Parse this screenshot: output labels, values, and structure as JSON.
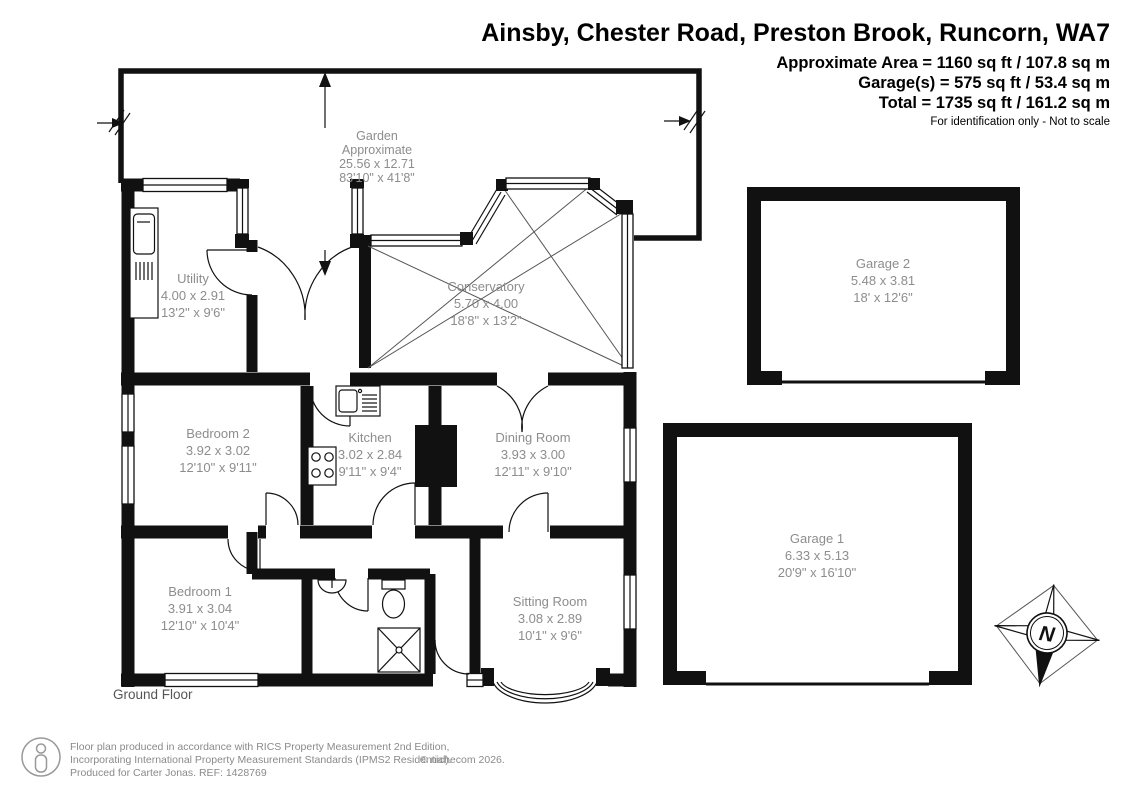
{
  "header": {
    "title": "Ainsby, Chester Road, Preston Brook, Runcorn, WA7",
    "approx_area": "Approximate Area = 1160 sq ft / 107.8 sq m",
    "garages": "Garage(s) = 575 sq ft / 53.4 sq m",
    "total": "Total = 1735 sq ft / 161.2 sq m",
    "disclaimer": "For identification only - Not to scale"
  },
  "floor": {
    "label": "Ground Floor"
  },
  "compass": {
    "north": "N"
  },
  "rooms": {
    "garden": {
      "name": "Garden",
      "sub": "Approximate",
      "metric": "25.56 x 12.71",
      "imperial": "83'10\" x 41'8\""
    },
    "utility": {
      "name": "Utility",
      "metric": "4.00 x 2.91",
      "imperial": "13'2\" x 9'6\""
    },
    "conservatory": {
      "name": "Conservatory",
      "metric": "5.70 x 4.00",
      "imperial": "18'8\" x 13'2\""
    },
    "bedroom2": {
      "name": "Bedroom 2",
      "metric": "3.92 x 3.02",
      "imperial": "12'10\" x 9'11\""
    },
    "kitchen": {
      "name": "Kitchen",
      "metric": "3.02 x 2.84",
      "imperial": "9'11\" x 9'4\""
    },
    "dining": {
      "name": "Dining Room",
      "metric": "3.93 x 3.00",
      "imperial": "12'11\" x 9'10\""
    },
    "bedroom1": {
      "name": "Bedroom 1",
      "metric": "3.91 x 3.04",
      "imperial": "12'10\" x 10'4\""
    },
    "sitting": {
      "name": "Sitting Room",
      "metric": "3.08 x 2.89",
      "imperial": "10'1\" x 9'6\""
    },
    "garage2": {
      "name": "Garage 2",
      "metric": "5.48 x 3.81",
      "imperial": "18' x 12'6\""
    },
    "garage1": {
      "name": "Garage 1",
      "metric": "6.33 x 5.13",
      "imperial": "20'9\" x 16'10\""
    }
  },
  "footer": {
    "line1": "Floor plan produced in accordance with RICS Property Measurement 2nd Edition,",
    "line2": "Incorporating International Property Measurement Standards (IPMS2 Residential).",
    "copyright": "© nichecom 2026.",
    "line3": "Produced for Carter Jonas.   REF: 1428769"
  },
  "colors": {
    "wall": "#111111",
    "label_gray": "#8d8d8d",
    "footer_gray": "#8a8a8a"
  }
}
